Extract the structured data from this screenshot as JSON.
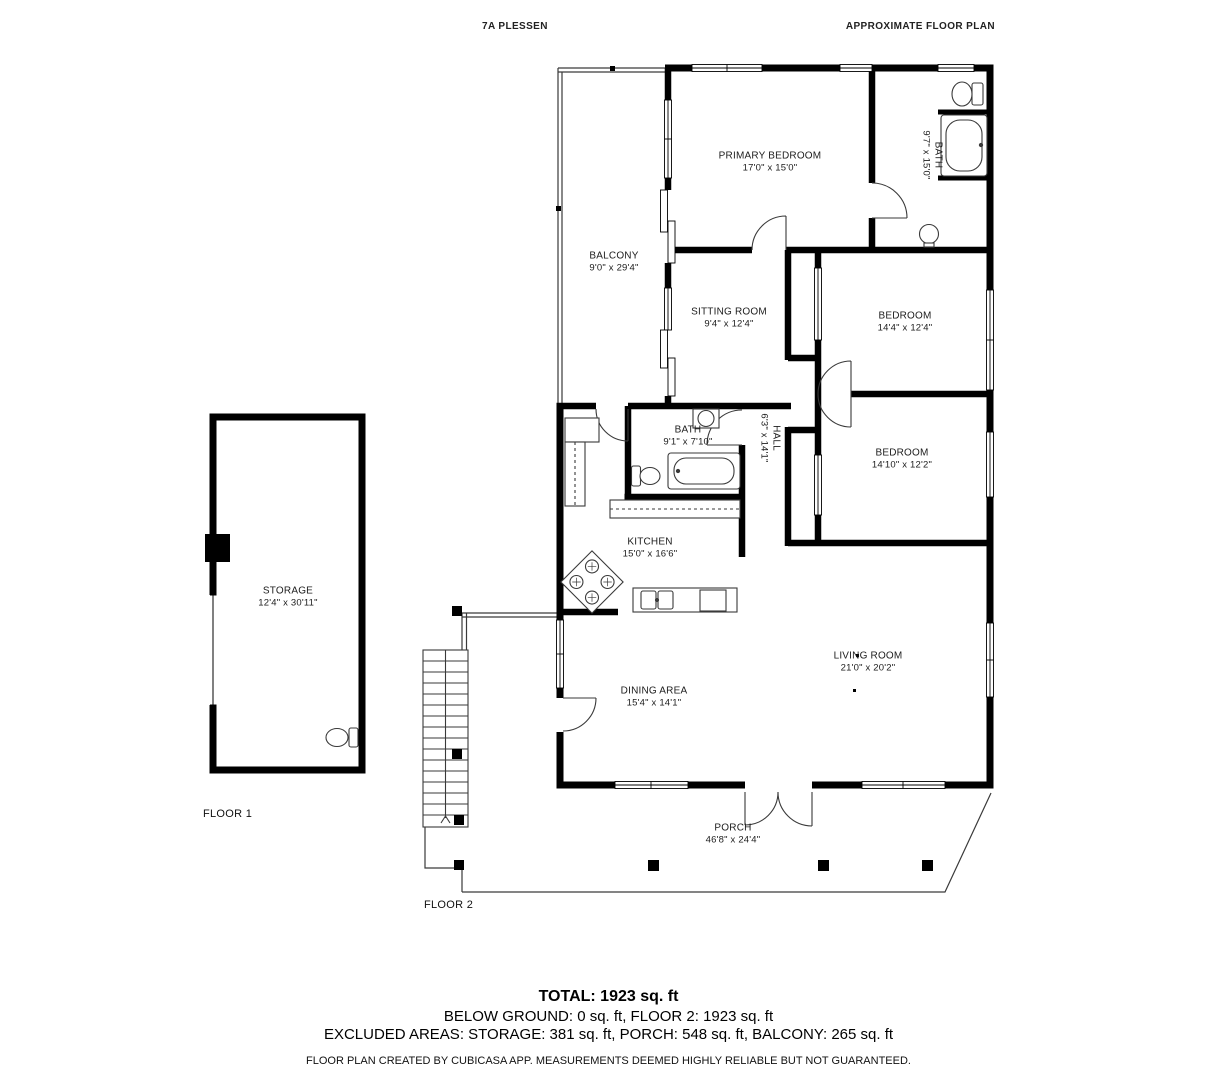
{
  "header": {
    "left": "7A PLESSEN",
    "right": "APPROXIMATE FLOOR PLAN"
  },
  "rooms": [
    {
      "name": "PRIMARY BEDROOM",
      "dims": "17'0\" x 15'0\""
    },
    {
      "name": "BATH",
      "dims": "9'7\" x 15'0\""
    },
    {
      "name": "BALCONY",
      "dims": "9'0\" x 29'4\""
    },
    {
      "name": "SITTING ROOM",
      "dims": "9'4\" x 12'4\""
    },
    {
      "name": "BEDROOM",
      "dims": "14'4\" x 12'4\""
    },
    {
      "name": "BATH",
      "dims": "9'1\" x 7'10\""
    },
    {
      "name": "HALL",
      "dims": "6'3\" x 14'1\""
    },
    {
      "name": "BEDROOM",
      "dims": "14'10\" x 12'2\""
    },
    {
      "name": "KITCHEN",
      "dims": "15'0\" x 16'6\""
    },
    {
      "name": "STORAGE",
      "dims": "12'4\" x 30'11\""
    },
    {
      "name": "LIVING ROOM",
      "dims": "21'0\" x 20'2\""
    },
    {
      "name": "DINING AREA",
      "dims": "15'4\" x 14'1\""
    },
    {
      "name": "PORCH",
      "dims": "46'8\" x 24'4\""
    }
  ],
  "floors": {
    "floor1": "FLOOR 1",
    "floor2": "FLOOR 2"
  },
  "summary": {
    "total": "TOTAL: 1923 sq. ft",
    "below_ground_line": "BELOW GROUND: 0 sq. ft, FLOOR 2: 1923 sq. ft",
    "excluded_line": "EXCLUDED AREAS: STORAGE: 381 sq. ft, PORCH: 548 sq. ft, BALCONY: 265 sq. ft",
    "disclaimer": "FLOOR PLAN CREATED BY CUBICASA APP. MEASUREMENTS DEEMED HIGHLY RELIABLE BUT NOT GUARANTEED."
  },
  "colors": {
    "wall": "#000000",
    "thin_line": "#3a3a3a",
    "text": "#1c1c1c",
    "bg": "#ffffff"
  }
}
